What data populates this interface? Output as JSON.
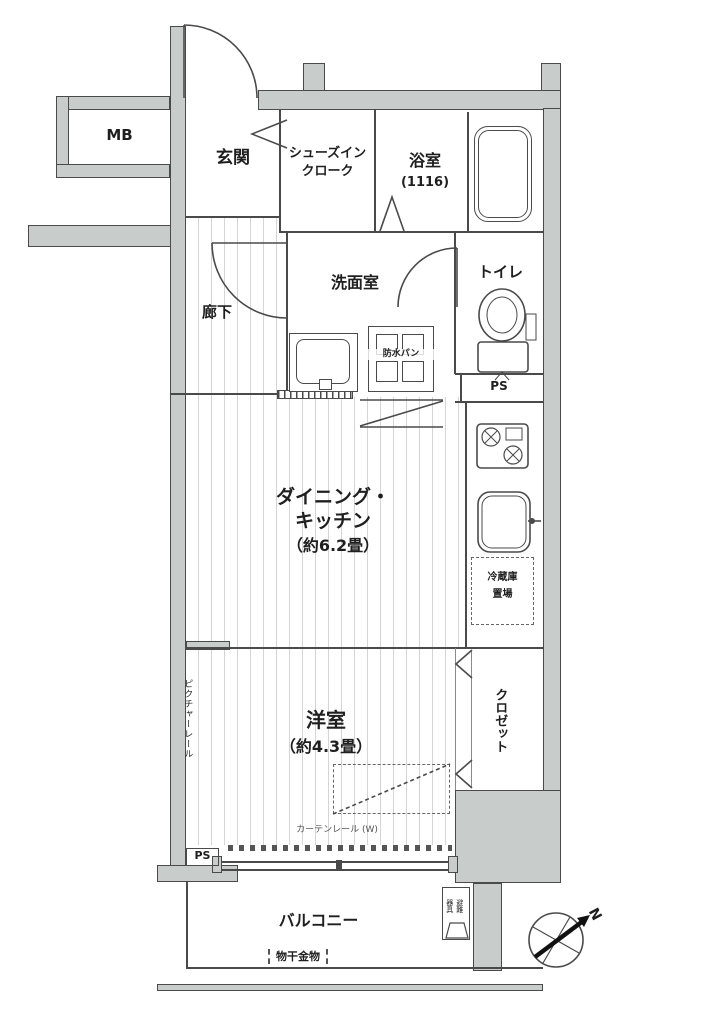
{
  "floorplan": {
    "type": "apartment-floor-plan",
    "labels": {
      "mb": "MB",
      "genkan": "玄関",
      "shoes_closet_line1": "シューズイン",
      "shoes_closet_line2": "クローク",
      "bathroom": "浴室",
      "bathroom_size": "(1116)",
      "corridor": "廊下",
      "washroom": "洗面室",
      "toilet": "トイレ",
      "waterproof_pan": "防水パン",
      "ps_upper": "PS",
      "dk_line1": "ダイニング・",
      "dk_line2": "キッチン",
      "dk_size": "（約6.2畳）",
      "fridge_line1": "冷蔵庫",
      "fridge_line2": "置場",
      "western_room": "洋室",
      "western_room_size": "（約4.3畳）",
      "closet": "クロゼット",
      "picture_rail": "ピクチャーレール",
      "curtain_rail": "カーテンレール (W)",
      "ps_lower": "PS",
      "balcony": "バルコニー",
      "laundry_hardware": "物干金物",
      "evacuation_line1": "避難",
      "evacuation_line2": "器具",
      "compass_north": "N"
    },
    "colors": {
      "wall_fill": "#c8cccb",
      "line": "#4a4a4a",
      "text": "#1f1f1f",
      "floor_stripe": "#d5d5d5",
      "background": "#ffffff"
    }
  }
}
